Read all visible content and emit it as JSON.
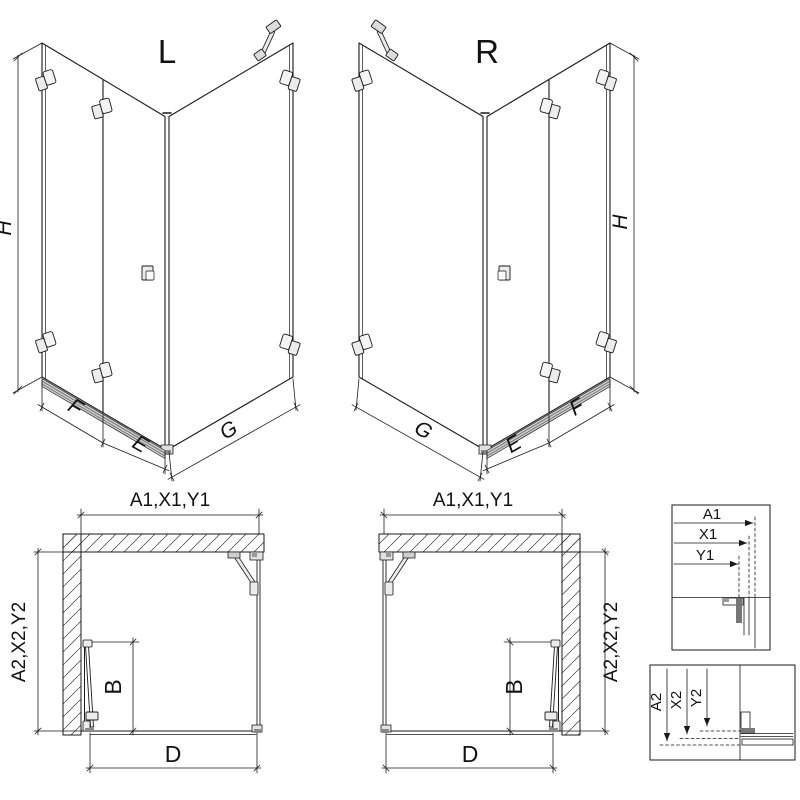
{
  "colors": {
    "line": "#1a1a1a",
    "hardware": "#ececec",
    "threshold": "#8a8a8a",
    "background": "#ffffff"
  },
  "iso_left": {
    "label": "L",
    "dim_height": "H",
    "dim_fixed_width": "F",
    "dim_door_width": "E",
    "dim_side_width": "G"
  },
  "iso_right": {
    "label": "R",
    "dim_height": "H",
    "dim_fixed_width": "F",
    "dim_door_width": "E",
    "dim_side_width": "G"
  },
  "plan_left": {
    "dim_top": "A1,X1,Y1",
    "dim_side": "A2,X2,Y2",
    "dim_door": "B",
    "dim_bottom": "D"
  },
  "plan_right": {
    "dim_top": "A1,X1,Y1",
    "dim_side": "A2,X2,Y2",
    "dim_door": "B",
    "dim_bottom": "D"
  },
  "detail_top": {
    "row1": "A1",
    "row2": "X1",
    "row3": "Y1"
  },
  "detail_bottom": {
    "row1": "A2",
    "row2": "X2",
    "row3": "Y2"
  }
}
